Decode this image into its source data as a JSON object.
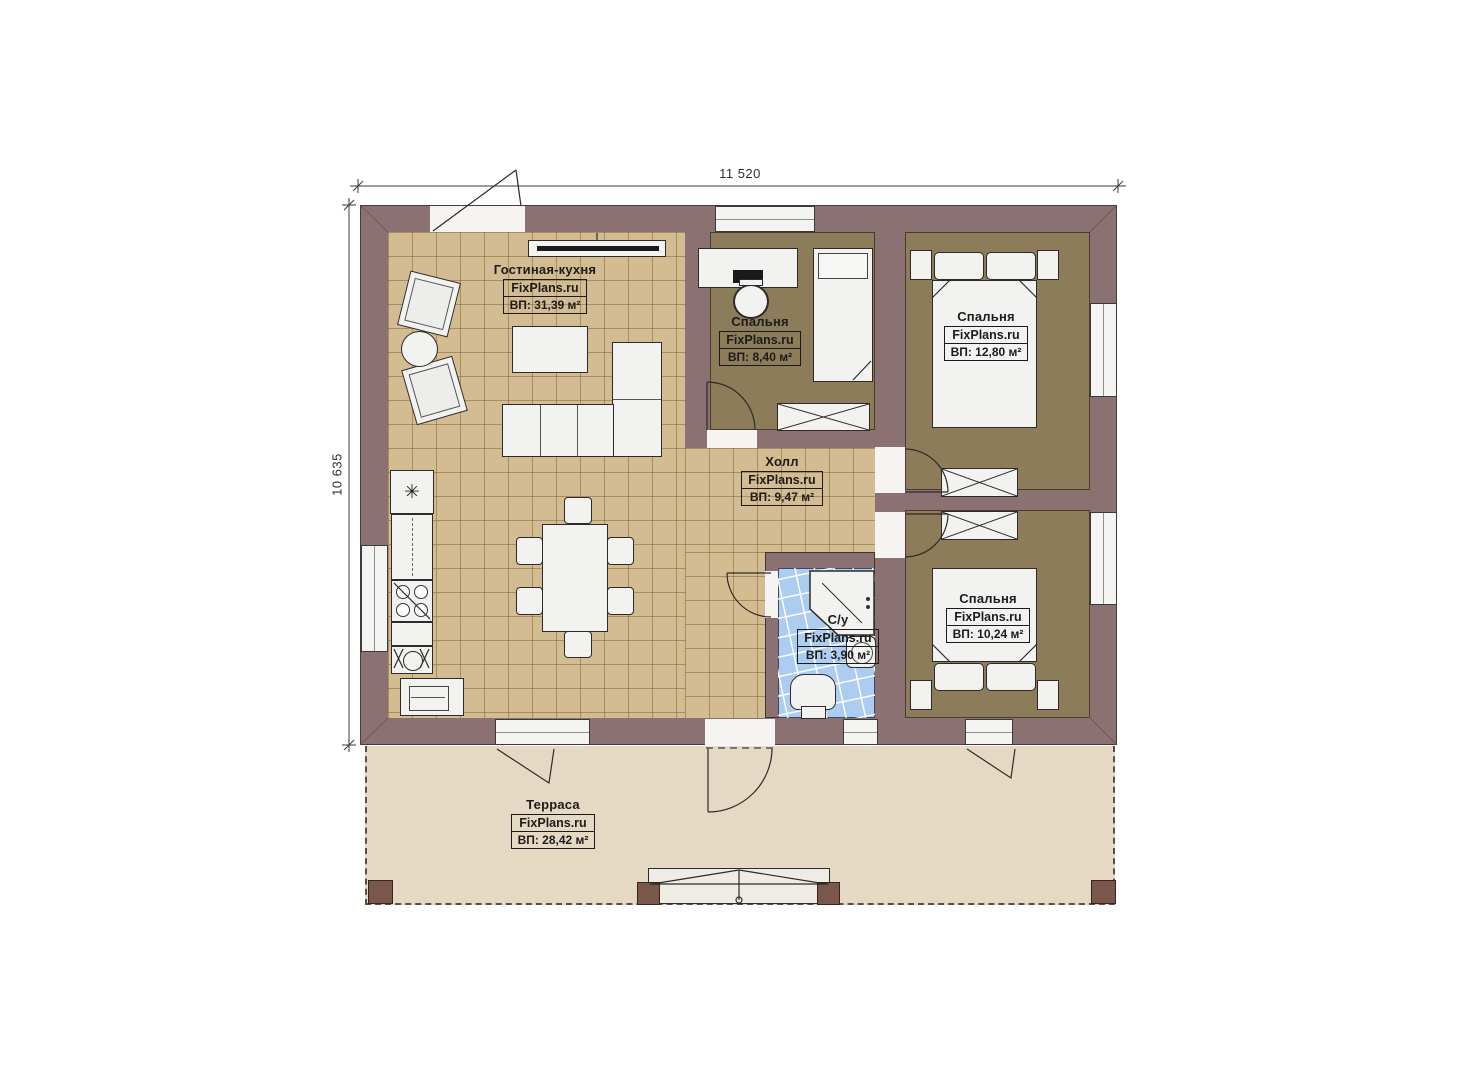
{
  "plan": {
    "dimensions": {
      "width": "11 520",
      "height": "10 635"
    },
    "rooms": [
      {
        "name": "Гостиная-кухня",
        "brand": "FixPlans.ru",
        "area": "ВП: 31,39 м²"
      },
      {
        "name": "Спальня",
        "brand": "FixPlans.ru",
        "area": "ВП: 8,40 м²"
      },
      {
        "name": "Спальня",
        "brand": "FixPlans.ru",
        "area": "ВП: 12,80 м²"
      },
      {
        "name": "Холл",
        "brand": "FixPlans.ru",
        "area": "ВП: 9,47 м²"
      },
      {
        "name": "С/у",
        "brand": "FixPlans.ru",
        "area": "ВП: 3,90 м²"
      },
      {
        "name": "Спальня",
        "brand": "FixPlans.ru",
        "area": "ВП: 10,24 м²"
      },
      {
        "name": "Терраса",
        "brand": "FixPlans.ru",
        "area": "ВП: 28,42 м²"
      }
    ],
    "icons": {
      "fridge_snowflake": "✳"
    },
    "colors": {
      "wall": "#8b7172",
      "floor_tile": "#d3bc91",
      "floor_bedroom": "#8d7c5a",
      "floor_bath": "#accdf0",
      "terrace": "#e5d9c4",
      "furniture": "#f2f2f0",
      "post": "#7a574a"
    }
  }
}
